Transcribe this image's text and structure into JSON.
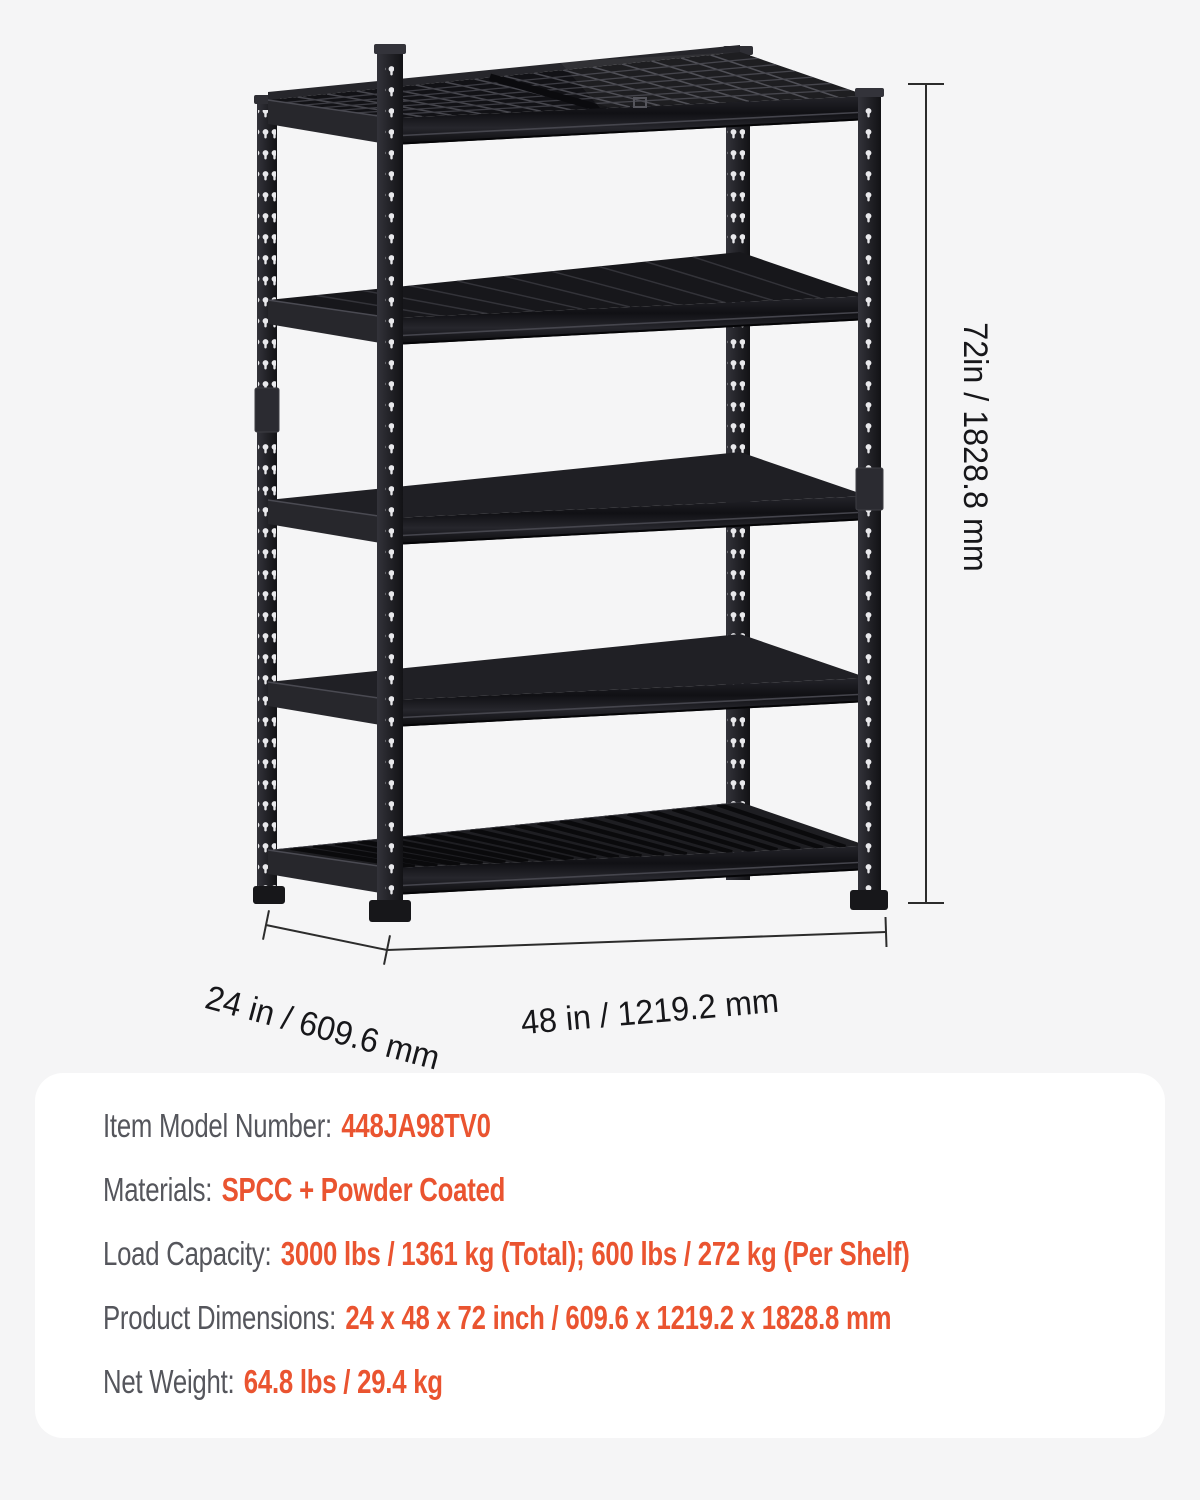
{
  "page": {
    "background_color": "#f5f5f6",
    "panel_color": "#ffffff"
  },
  "diagram": {
    "subject": "5-tier black steel garage storage shelving rack",
    "shelf_count": 5,
    "rack_color": "#222227",
    "dimension_text_color": "#17171a",
    "dimension_line_color": "#2c2c2c",
    "dimensions": {
      "height_label": "72in / 1828.8 mm",
      "depth_label": "24 in / 609.6 mm",
      "width_label": "48 in / 1219.2 mm"
    }
  },
  "specs": {
    "label_color": "#55565c",
    "value_color": "#ea5430",
    "rows": [
      {
        "label": "Item Model Number:",
        "value": "448JA98TV0"
      },
      {
        "label": "Materials:",
        "value": "SPCC + Powder Coated"
      },
      {
        "label": "Load Capacity:",
        "value": "3000 lbs / 1361 kg (Total); 600 lbs / 272 kg (Per Shelf)"
      },
      {
        "label": "Product Dimensions:",
        "value": "24 x 48 x 72 inch / 609.6 x 1219.2 x 1828.8 mm"
      },
      {
        "label": "Net Weight:",
        "value": "64.8 lbs / 29.4 kg"
      }
    ]
  }
}
